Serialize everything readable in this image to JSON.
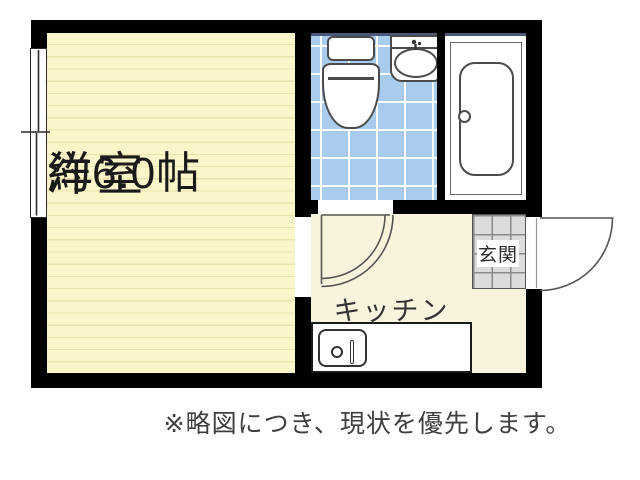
{
  "plan": {
    "rooms": {
      "western_room": {
        "name": "洋室",
        "size": "約6.0帖"
      },
      "kitchen": {
        "name": "キッチン"
      },
      "entrance": {
        "name": "玄関"
      }
    },
    "fixtures": [
      "toilet-icon",
      "washbasin-icon",
      "bathtub-icon",
      "kitchen-sink-icon",
      "window-symbol",
      "bathroom-door-swing",
      "entrance-door-swing"
    ],
    "disclaimer": "※略図につき、現状を優先します。"
  },
  "colors": {
    "wall": "#000000",
    "room_floor": "#faf6ca",
    "room_stripe": "#ebe3ae",
    "kitchen_floor": "#f7f3dd",
    "tile_blue": "#a9cbee",
    "tile_line": "#ffffff",
    "genkan_gray": "#dcdcdc",
    "genkan_line": "#8a8a8a",
    "fixture_line": "#4a4a4a",
    "door_arc": "#555555",
    "text": "#1a1a1a",
    "note_text": "#3f3f3f",
    "bath_top_line": "#4a5878"
  }
}
